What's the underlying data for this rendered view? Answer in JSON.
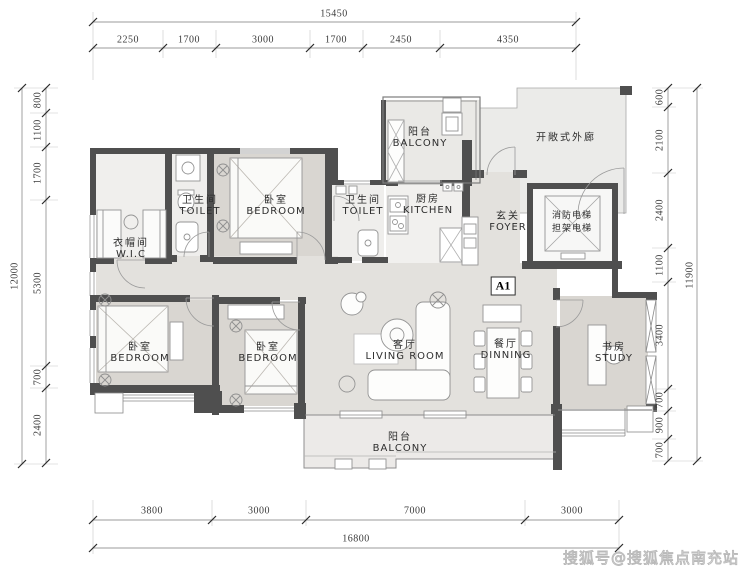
{
  "meta": {
    "watermark": "搜狐号@搜狐焦点南充站",
    "unit_badge": "A1"
  },
  "rooms": [
    {
      "id": "balcony-top",
      "zh": "阳台",
      "en": "BALCONY"
    },
    {
      "id": "open-corridor",
      "zh": "开敞式外廊",
      "en": ""
    },
    {
      "id": "toilet-1",
      "zh": "卫生间",
      "en": "TOILET"
    },
    {
      "id": "bedroom-top",
      "zh": "卧室",
      "en": "BEDROOM"
    },
    {
      "id": "toilet-2",
      "zh": "卫生间",
      "en": "TOILET"
    },
    {
      "id": "kitchen",
      "zh": "厨房",
      "en": "KITCHEN"
    },
    {
      "id": "foyer",
      "zh": "玄关",
      "en": "FOYER"
    },
    {
      "id": "elevator",
      "zh": "消防电梯",
      "zh2": "担架电梯",
      "en": ""
    },
    {
      "id": "wic",
      "zh": "衣帽间",
      "en": "W.I.C"
    },
    {
      "id": "bedroom-left",
      "zh": "卧室",
      "en": "BEDROOM"
    },
    {
      "id": "bedroom-mid",
      "zh": "卧室",
      "en": "BEDROOM"
    },
    {
      "id": "living-room",
      "zh": "客厅",
      "en": "LIVING ROOM"
    },
    {
      "id": "dining-room",
      "zh": "餐厅",
      "en": "DINNING"
    },
    {
      "id": "study",
      "zh": "书房",
      "en": "STUDY"
    },
    {
      "id": "balcony-bottom",
      "zh": "阳台",
      "en": "BALCONY"
    }
  ],
  "dimensions": {
    "top": {
      "total": "15450",
      "segments": [
        "2250",
        "1700",
        "3000",
        "1700",
        "2450",
        "4350"
      ]
    },
    "left": {
      "total": "12000",
      "segments": [
        "800",
        "1100",
        "1700",
        "5300",
        "700",
        "2400"
      ]
    },
    "right": {
      "total": "11900",
      "segments": [
        "600",
        "2100",
        "2400",
        "1100",
        "3400",
        "700",
        "900",
        "700"
      ]
    },
    "bottom": {
      "total": "16800",
      "segments": [
        "3800",
        "3000",
        "7000",
        "3000"
      ]
    }
  }
}
